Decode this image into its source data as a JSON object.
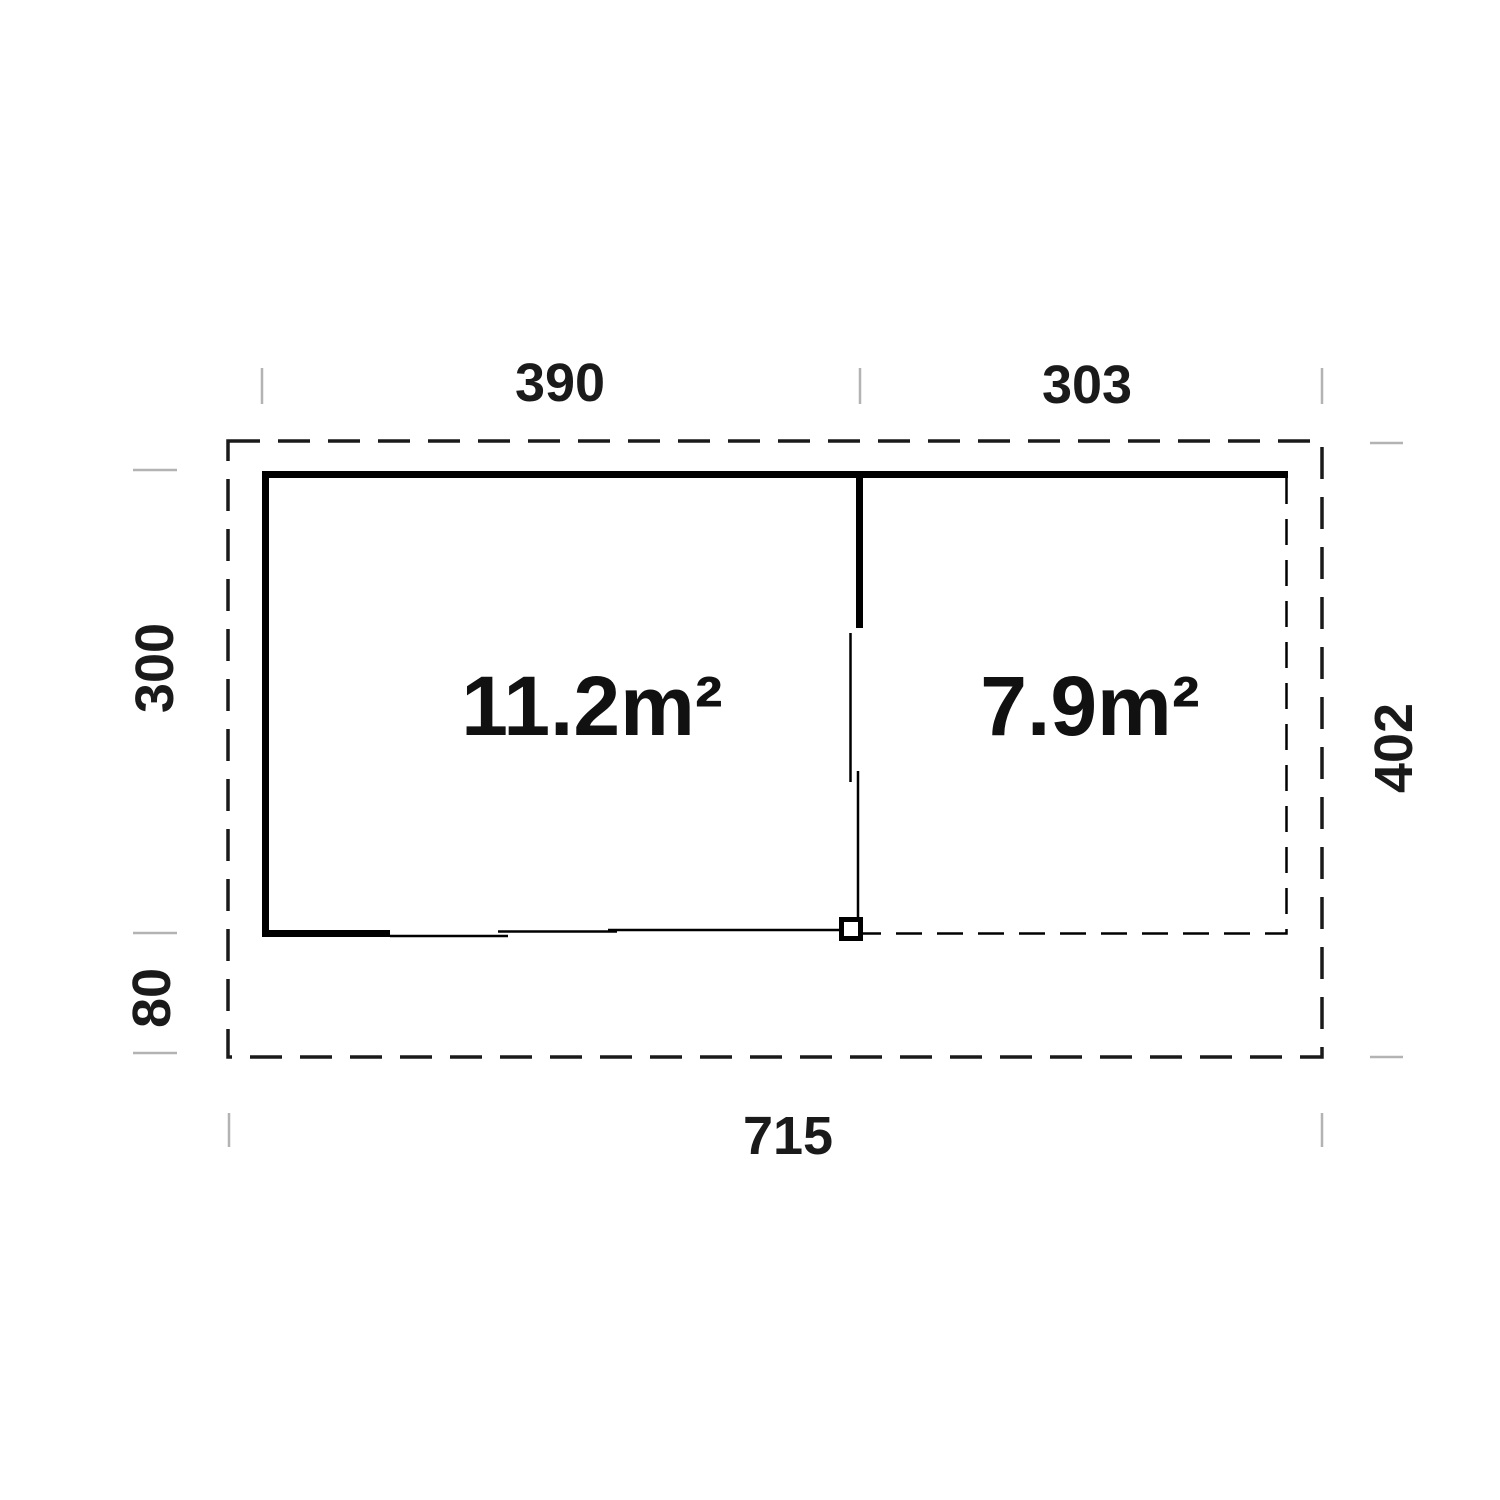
{
  "floor_plan": {
    "rooms": [
      {
        "area_label": "11.2m²"
      },
      {
        "area_label": "7.9m²"
      }
    ],
    "dimensions": {
      "top": [
        "390",
        "303"
      ],
      "left": [
        "300",
        "80"
      ],
      "right": [
        "402"
      ],
      "bottom": [
        "715"
      ]
    },
    "colors": {
      "wall": "#000000",
      "label": "#1a1a1a",
      "extension_tick": "#b3b3b3",
      "background": "#ffffff"
    }
  }
}
